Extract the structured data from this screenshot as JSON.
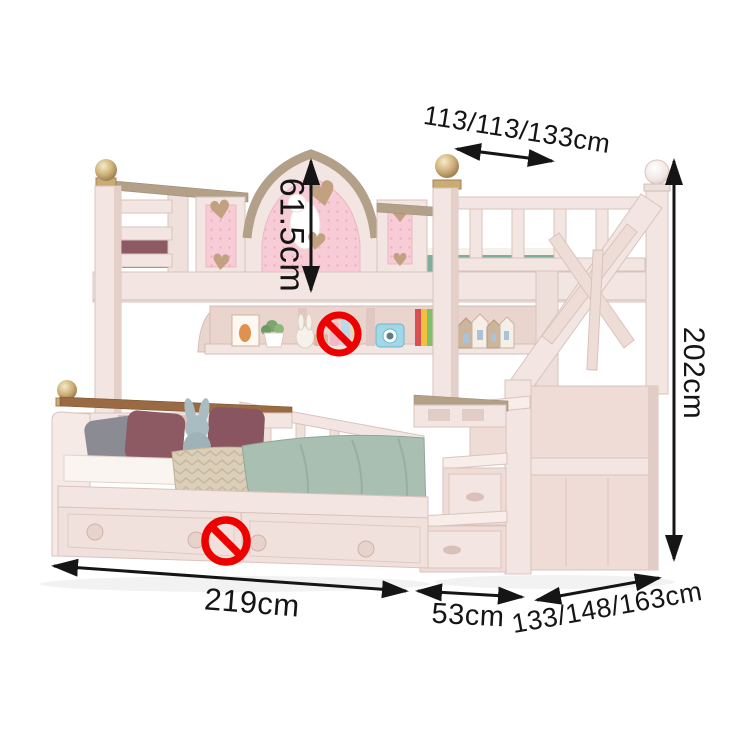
{
  "figure": {
    "kind": "product-dimension-diagram",
    "subject": "kids bunk bed with storage staircase and drawers"
  },
  "dimensions": [
    {
      "id": "top-bunk-width",
      "label": "113/113/133cm"
    },
    {
      "id": "headboard-height",
      "label": "61.5cm"
    },
    {
      "id": "overall-height",
      "label": "202cm"
    },
    {
      "id": "bed-length",
      "label": "219cm"
    },
    {
      "id": "stair-depth",
      "label": "53cm"
    },
    {
      "id": "lower-bed-width",
      "label": "133/148/163cm"
    }
  ],
  "icons": {
    "shelf_marker": "no-sign",
    "drawer_marker": "no-sign"
  },
  "colors": {
    "annotation": "#151515",
    "prohibited": "#ee0000",
    "frame_light": "#f3e5e1",
    "frame_edge": "#d9c3bd",
    "frame_shadow": "#e7d2cc",
    "wood_tan": "#b3a089",
    "wood_brown": "#9a6b42",
    "gold": "#c9ab74",
    "pink_panel": "#f8ccd6",
    "heart_tan": "#c2a182",
    "duvet_sage": "#a9bfb1",
    "blanket_beige": "#dbcfba",
    "pillow_mauve": "#8d5a63",
    "pillow_gray": "#8b8b93",
    "top_blanket_teal": "#7fae9e",
    "camera_blue": "#9fd9e8"
  }
}
